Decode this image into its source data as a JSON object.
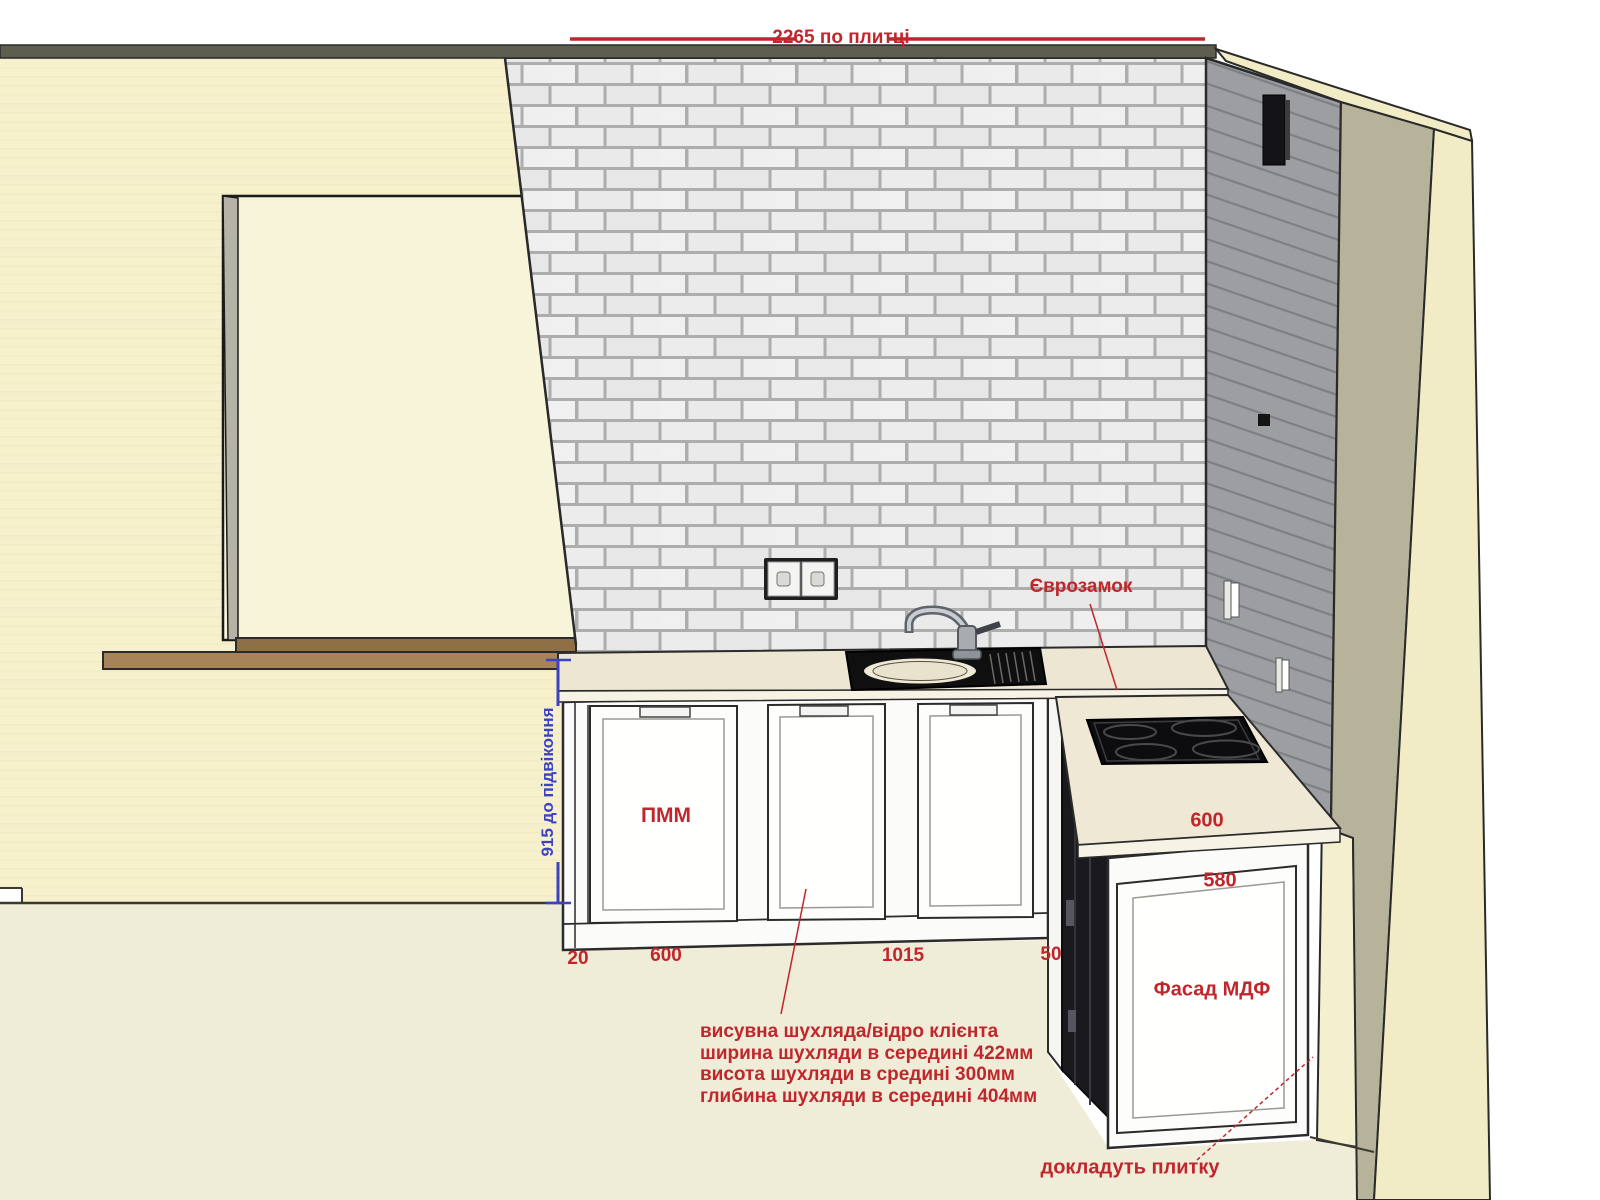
{
  "dimensions": {
    "top_tile_width": "2265 по плитці",
    "sill_height": "915 до підвіконня",
    "base_left_gap": "20",
    "base_dishwasher_width": "600",
    "base_run_width": "1015",
    "base_right_gap": "50",
    "right_counter_depth": "600",
    "right_cabinet_width": "580"
  },
  "labels": {
    "euro_lock": "Єврозамок",
    "dishwasher": "ПММ",
    "facade": "Фасад МДФ",
    "add_tile": "докладуть плитку"
  },
  "drawer_note": {
    "lines": [
      "висувна шухляда/відро клієнта",
      "ширина шухляди в середині 422мм",
      "висота шухляди в средині 300мм",
      "глибина шухляди в середині 404мм"
    ]
  },
  "colors": {
    "annotation_red": "#c0262c",
    "annotation_blue": "#3c42c4",
    "wall_cream": "#f6f1cc",
    "floor_cream": "#efecd7",
    "brick_light": "#ececec",
    "brick_mortar": "#adadad",
    "gray_wall": "#9d9ea1",
    "olive_band": "#b6b39a",
    "sill_brown": "#9a7a4e",
    "cabinet_white": "#fbfbfa",
    "appliance_dark": "#1a1a1e"
  }
}
